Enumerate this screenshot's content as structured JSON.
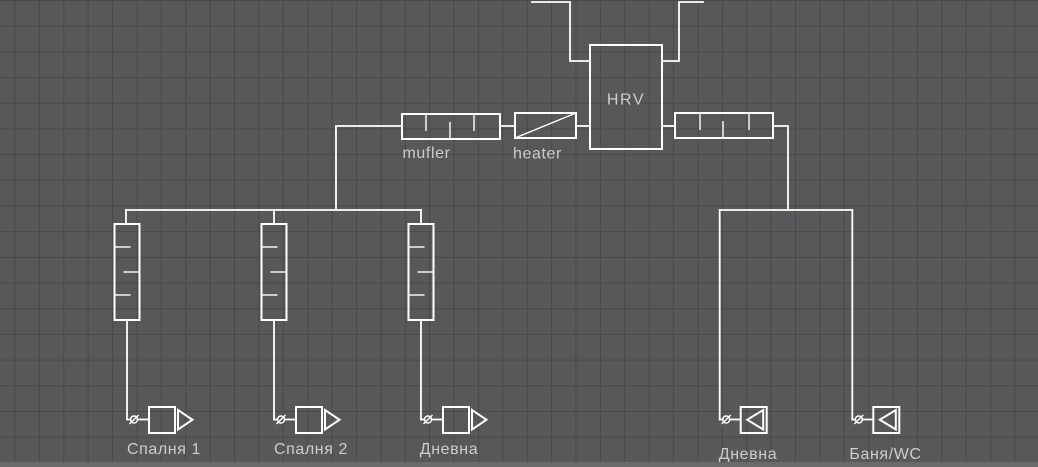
{
  "canvas": {
    "background_color": "#58585a",
    "grid_color": "#49494b",
    "line_color": "#ffffff",
    "label_color": "#cdcdcd"
  },
  "components": {
    "hrv": {
      "label": "HRV"
    },
    "supply_muffler": {
      "label": "mufler"
    },
    "heater": {
      "label": "heater"
    },
    "extract_muffler": {
      "label": ""
    }
  },
  "symbols": {
    "damper": "circle-with-slash",
    "supply_diffuser": "square-with-right-triangle",
    "extract_grille": "square-with-left-triangle",
    "silencer": "box-with-baffle-ticks"
  },
  "supply_terminals": [
    {
      "room": "Спалня 1"
    },
    {
      "room": "Спалня 2"
    },
    {
      "room": "Дневна"
    }
  ],
  "extract_terminals": [
    {
      "room": "Дневна"
    },
    {
      "room": "Баня/WC"
    }
  ]
}
